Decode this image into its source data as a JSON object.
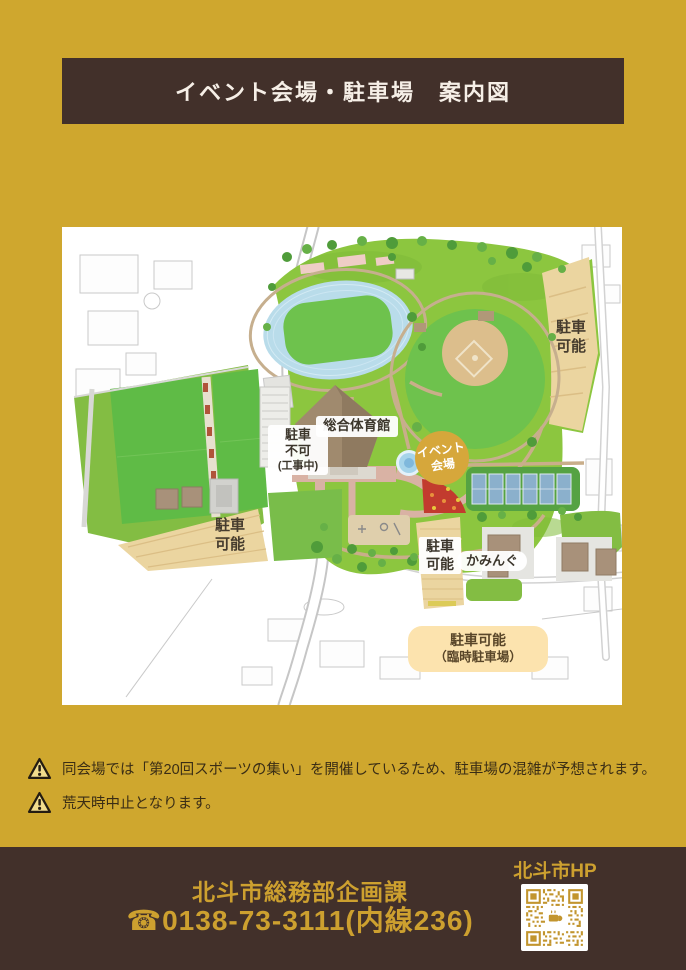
{
  "colors": {
    "page_bg": "#CFA72E",
    "panel_bg": "#FFFFFF",
    "bar_bg": "#42302A",
    "footer_text": "#CDA02F",
    "event_badge_bg": "#D6A73B",
    "parking_area_fill": "#EBD5A0",
    "temp_label_bg": "#FCE3AE"
  },
  "header": {
    "title": "イベント会場・駐車場　案内図"
  },
  "map": {
    "parking_ne": {
      "l1": "駐車",
      "l2": "可能"
    },
    "parking_construction": {
      "l1": "駐車",
      "l2": "不可",
      "l3": "(工事中)"
    },
    "gym_label": "総合体育館",
    "event_badge": {
      "l1": "イベント",
      "l2": "会場"
    },
    "parking_west": {
      "l1": "駐車",
      "l2": "可能"
    },
    "parking_south": {
      "l1": "駐車",
      "l2": "可能"
    },
    "kamingu_label": "かみんぐ",
    "temp_parking": {
      "l1": "駐車可能",
      "l2": "（臨時駐車場）"
    }
  },
  "notices": {
    "items": [
      {
        "icon": "warning-icon",
        "text": "同会場では「第20回スポーツの集い」を開催しているため、駐車場の混雑が予想されます。"
      },
      {
        "icon": "warning-icon",
        "text": "荒天時中止となります。"
      }
    ]
  },
  "footer": {
    "department": "北斗市総務部企画課",
    "phone": "☎0138-73-3111(内線236)",
    "hp_label": "北斗市HP",
    "qr_icon": "qr-code"
  }
}
